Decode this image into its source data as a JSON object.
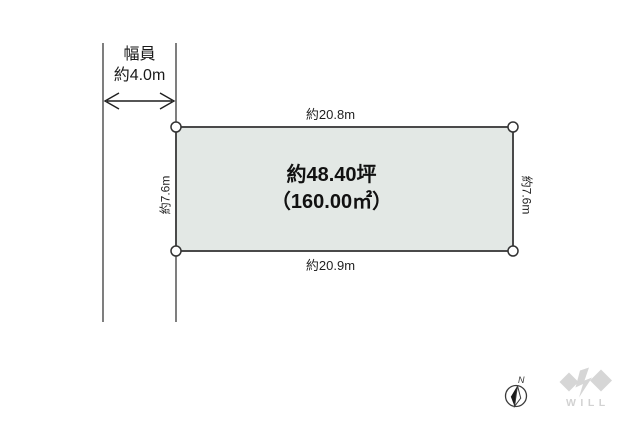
{
  "diagram": {
    "road": {
      "width_label_line1": "幅員",
      "width_label_line2": "約4.0m"
    },
    "plot": {
      "top_dimension": "約20.8m",
      "bottom_dimension": "約20.9m",
      "left_dimension": "約7.6m",
      "right_dimension": "約7.6m",
      "area_tsubo": "約48.40坪",
      "area_sqm": "（160.00㎡）",
      "fill_color": "#e3e8e5",
      "border_color": "#4a4a4a"
    },
    "compass": {
      "north_label": "N"
    },
    "logo": {
      "text": "WILL",
      "color": "#d6d6d6",
      "text_color": "#d2d2d2"
    }
  }
}
